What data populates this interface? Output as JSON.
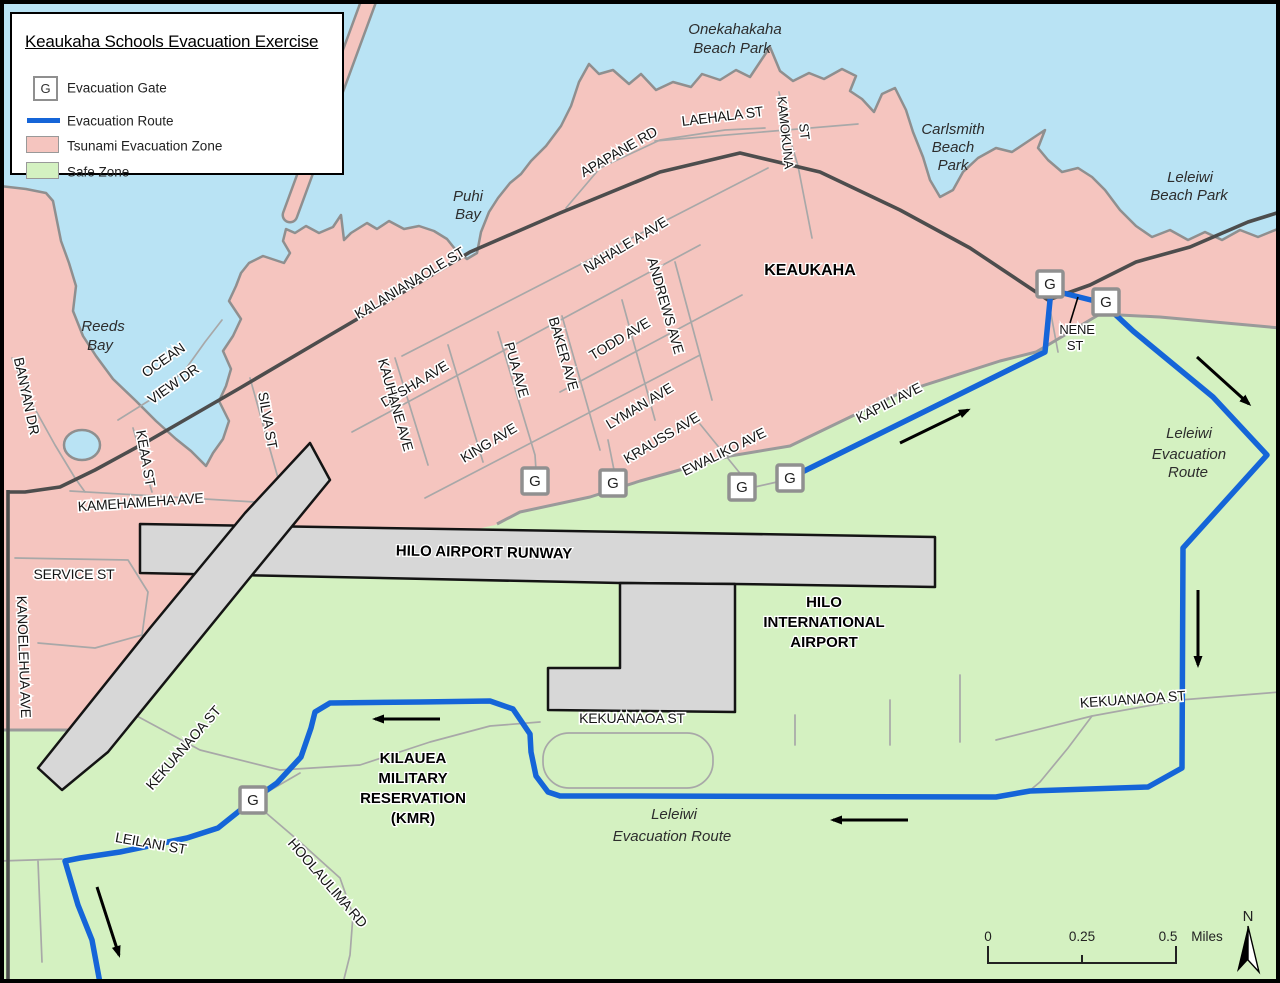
{
  "colors": {
    "water": "#b9e3f4",
    "tsunami": "#f5c5bf",
    "safe": "#d4f1c1",
    "runway": "#d7d7d7",
    "route": "#1565d8",
    "road": "#a8a8a8",
    "road_major": "#4d4d4d",
    "boundary": "#9a9a9a",
    "coast": "#8f8f8f"
  },
  "legend": {
    "title": "Keaukaha Schools Evacuation Exercise",
    "gate_symbol": "G",
    "items": [
      {
        "key": "gate",
        "label": "Evacuation Gate"
      },
      {
        "key": "route",
        "label": "Evacuation Route"
      },
      {
        "key": "tsunami",
        "label": "Tsunami Evacuation Zone"
      },
      {
        "key": "safe",
        "label": "Safe Zone"
      }
    ]
  },
  "map": {
    "labels": [
      {
        "t": "KALANIANAOLE ST",
        "x": 412,
        "y": 287,
        "r": -31,
        "c": "st",
        "s": 14
      },
      {
        "t": "NAHALE A AVE",
        "x": 628,
        "y": 249,
        "r": -31,
        "c": "st",
        "s": 14
      },
      {
        "t": "APAPANE RD",
        "x": 621,
        "y": 156,
        "r": -30,
        "c": "st",
        "s": 14
      },
      {
        "t": "LAEHALA ST",
        "x": 723,
        "y": 121,
        "r": -7,
        "c": "st",
        "s": 14
      },
      {
        "t": "KAMOKUNA",
        "x": 781,
        "y": 133,
        "r": 84,
        "c": "st",
        "s": 13
      },
      {
        "t": "ST",
        "x": 800,
        "y": 132,
        "r": 84,
        "c": "st",
        "s": 13
      },
      {
        "t": "DESHA AVE",
        "x": 417,
        "y": 388,
        "r": -31,
        "c": "st",
        "s": 14
      },
      {
        "t": "PUA AVE",
        "x": 512,
        "y": 371,
        "r": 74,
        "c": "st",
        "s": 14
      },
      {
        "t": "BAKER AVE",
        "x": 559,
        "y": 355,
        "r": 74,
        "c": "st",
        "s": 14
      },
      {
        "t": "TODD AVE",
        "x": 622,
        "y": 343,
        "r": -31,
        "c": "st",
        "s": 14
      },
      {
        "t": "ANDREWS AVE",
        "x": 661,
        "y": 307,
        "r": 74,
        "c": "st",
        "s": 14
      },
      {
        "t": "KAUHANE AVE",
        "x": 391,
        "y": 406,
        "r": 74,
        "c": "st",
        "s": 14
      },
      {
        "t": "KING AVE",
        "x": 491,
        "y": 447,
        "r": -31,
        "c": "st",
        "s": 14
      },
      {
        "t": "LYMAN AVE",
        "x": 642,
        "y": 410,
        "r": -31,
        "c": "st",
        "s": 14
      },
      {
        "t": "KRAUSS AVE",
        "x": 664,
        "y": 442,
        "r": -31,
        "c": "st",
        "s": 14
      },
      {
        "t": "EWALIKO AVE",
        "x": 726,
        "y": 456,
        "r": -26,
        "c": "st",
        "s": 14
      },
      {
        "t": "KAPILI AVE",
        "x": 891,
        "y": 407,
        "r": -27,
        "c": "st",
        "s": 14
      },
      {
        "t": "NENE",
        "x": 1077,
        "y": 334,
        "r": 0,
        "c": "st",
        "s": 13
      },
      {
        "t": "ST",
        "x": 1075,
        "y": 350,
        "r": 0,
        "c": "st",
        "s": 13
      },
      {
        "t": "OCEAN",
        "x": 166,
        "y": 364,
        "r": -35,
        "c": "st",
        "s": 14
      },
      {
        "t": "VIEW DR",
        "x": 176,
        "y": 388,
        "r": -35,
        "c": "st",
        "s": 14
      },
      {
        "t": "BANYAN DR",
        "x": 22,
        "y": 397,
        "r": 78,
        "c": "st",
        "s": 14
      },
      {
        "t": "KEAA ST",
        "x": 141,
        "y": 459,
        "r": 80,
        "c": "st",
        "s": 14
      },
      {
        "t": "SILVA ST",
        "x": 263,
        "y": 421,
        "r": 80,
        "c": "st",
        "s": 14
      },
      {
        "t": "KAMEHAMEHA AVE",
        "x": 141,
        "y": 507,
        "r": -4,
        "c": "st",
        "s": 14
      },
      {
        "t": "SERVICE ST",
        "x": 74,
        "y": 579,
        "r": 0,
        "c": "st",
        "s": 14
      },
      {
        "t": "KANOELEHUA AVE",
        "x": 19,
        "y": 657,
        "r": 88,
        "c": "st",
        "s": 14
      },
      {
        "t": "KEKUANAOA ST",
        "x": 187,
        "y": 751,
        "r": -49,
        "c": "st",
        "s": 14
      },
      {
        "t": "KEKUANAOA ST",
        "x": 632,
        "y": 723,
        "r": 0,
        "c": "st",
        "s": 14
      },
      {
        "t": "KEKUANAOA ST",
        "x": 1133,
        "y": 704,
        "r": -4,
        "c": "st",
        "s": 14
      },
      {
        "t": "LEILANI ST",
        "x": 150,
        "y": 848,
        "r": 10,
        "c": "st",
        "s": 14
      },
      {
        "t": "HOOLAULIMA RD",
        "x": 324,
        "y": 886,
        "r": 49,
        "c": "st",
        "s": 14
      },
      {
        "t": "KEAUKAHA",
        "x": 810,
        "y": 275,
        "r": 0,
        "c": "pl",
        "s": 16
      },
      {
        "t": "HILO AIRPORT RUNWAY",
        "x": 484,
        "y": 557,
        "r": 1,
        "c": "pl",
        "s": 15
      },
      {
        "t": "HILO",
        "x": 824,
        "y": 607,
        "r": 0,
        "c": "pl",
        "s": 15
      },
      {
        "t": "INTERNATIONAL",
        "x": 824,
        "y": 627,
        "r": 0,
        "c": "pl",
        "s": 15
      },
      {
        "t": "AIRPORT",
        "x": 824,
        "y": 647,
        "r": 0,
        "c": "pl",
        "s": 15
      },
      {
        "t": "KILAUEA",
        "x": 413,
        "y": 763,
        "r": 0,
        "c": "pl",
        "s": 15
      },
      {
        "t": "MILITARY",
        "x": 413,
        "y": 783,
        "r": 0,
        "c": "pl",
        "s": 15
      },
      {
        "t": "RESERVATION",
        "x": 413,
        "y": 803,
        "r": 0,
        "c": "pl",
        "s": 15
      },
      {
        "t": "(KMR)",
        "x": 413,
        "y": 823,
        "r": 0,
        "c": "pl",
        "s": 15
      },
      {
        "t": "Onekahakaha",
        "x": 735,
        "y": 34,
        "r": 0,
        "c": "wt",
        "s": 15
      },
      {
        "t": "Beach Park",
        "x": 732,
        "y": 53,
        "r": 0,
        "c": "wt",
        "s": 15
      },
      {
        "t": "Carlsmith",
        "x": 953,
        "y": 134,
        "r": 0,
        "c": "wt",
        "s": 15
      },
      {
        "t": "Beach",
        "x": 953,
        "y": 152,
        "r": 0,
        "c": "wt",
        "s": 15
      },
      {
        "t": "Park",
        "x": 953,
        "y": 170,
        "r": 0,
        "c": "wt",
        "s": 15
      },
      {
        "t": "Leleiwi",
        "x": 1190,
        "y": 182,
        "r": 0,
        "c": "wt",
        "s": 15
      },
      {
        "t": "Beach Park",
        "x": 1189,
        "y": 200,
        "r": 0,
        "c": "wt",
        "s": 15
      },
      {
        "t": "Puhi",
        "x": 468,
        "y": 201,
        "r": 0,
        "c": "wt",
        "s": 15
      },
      {
        "t": "Bay",
        "x": 468,
        "y": 219,
        "r": 0,
        "c": "wt",
        "s": 15
      },
      {
        "t": "Reeds",
        "x": 103,
        "y": 331,
        "r": 0,
        "c": "wt",
        "s": 15
      },
      {
        "t": "Bay",
        "x": 100,
        "y": 350,
        "r": 0,
        "c": "wt",
        "s": 15
      },
      {
        "t": "Leleiwi",
        "x": 1189,
        "y": 438,
        "r": 0,
        "c": "wt",
        "s": 15
      },
      {
        "t": "Evacuation",
        "x": 1189,
        "y": 459,
        "r": 0,
        "c": "wt",
        "s": 15
      },
      {
        "t": "Route",
        "x": 1188,
        "y": 477,
        "r": 0,
        "c": "wt",
        "s": 15
      },
      {
        "t": "Leleiwi",
        "x": 674,
        "y": 819,
        "r": 0,
        "c": "wt",
        "s": 15
      },
      {
        "t": "Evacuation Route",
        "x": 672,
        "y": 841,
        "r": 0,
        "c": "wt",
        "s": 15
      }
    ],
    "gates": {
      "symbol": "G",
      "positions": [
        [
          535,
          481
        ],
        [
          613,
          483
        ],
        [
          742,
          487
        ],
        [
          790,
          478
        ],
        [
          1050,
          284
        ],
        [
          1106,
          302
        ],
        [
          253,
          800
        ]
      ]
    },
    "route": {
      "points": [
        [
          792,
          477
        ],
        [
          1045,
          352
        ],
        [
          1051,
          290
        ],
        [
          1103,
          303
        ],
        [
          1133,
          331
        ],
        [
          1213,
          397
        ],
        [
          1267,
          455
        ],
        [
          1183,
          548
        ],
        [
          1182,
          768
        ],
        [
          1148,
          787
        ],
        [
          1030,
          791
        ],
        [
          996,
          797
        ],
        [
          620,
          796
        ],
        [
          560,
          796
        ],
        [
          548,
          792
        ],
        [
          536,
          776
        ],
        [
          531,
          752
        ],
        [
          530,
          734
        ],
        [
          513,
          709
        ],
        [
          490,
          701
        ],
        [
          420,
          702
        ],
        [
          330,
          703
        ],
        [
          315,
          712
        ],
        [
          311,
          728
        ],
        [
          301,
          757
        ],
        [
          277,
          783
        ],
        [
          253,
          800
        ],
        [
          218,
          828
        ],
        [
          187,
          838
        ],
        [
          120,
          852
        ],
        [
          80,
          858
        ],
        [
          65,
          861
        ],
        [
          78,
          905
        ],
        [
          92,
          940
        ],
        [
          100,
          983
        ]
      ]
    },
    "arrows": [
      {
        "x1": 900,
        "y1": 443,
        "x2": 968,
        "y2": 410
      },
      {
        "x1": 1197,
        "y1": 357,
        "x2": 1249,
        "y2": 404
      },
      {
        "x1": 1198,
        "y1": 590,
        "x2": 1198,
        "y2": 665
      },
      {
        "x1": 908,
        "y1": 820,
        "x2": 833,
        "y2": 820
      },
      {
        "x1": 440,
        "y1": 719,
        "x2": 375,
        "y2": 719
      },
      {
        "x1": 97,
        "y1": 887,
        "x2": 119,
        "y2": 955
      }
    ],
    "scale_bar": {
      "ticks": [
        "0",
        "0.25",
        "0.5"
      ],
      "unit": "Miles"
    },
    "north_label": "N"
  }
}
